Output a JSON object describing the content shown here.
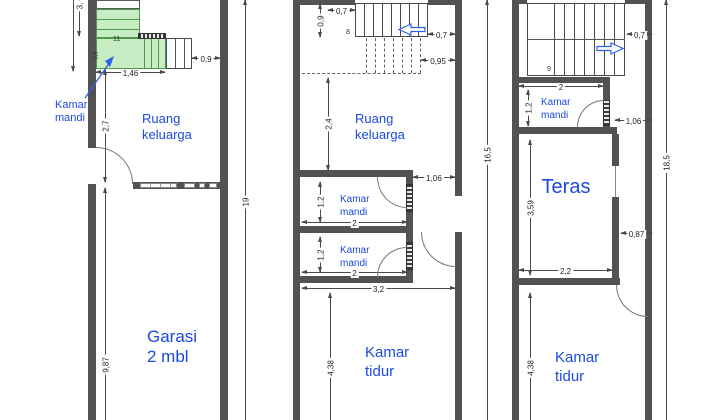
{
  "colors": {
    "wall_gray": "#525252",
    "stair_green_fill": "#c8edc4",
    "stair_green_line": "#4d9a4d",
    "room_label_blue": "#1c49e0",
    "direction_arrow_blue": "#2e62e8"
  },
  "plan_ground": {
    "labels": {
      "kamar_mandi": [
        "Kamar",
        "mandi"
      ],
      "ruang_keluarga": [
        "Ruang",
        "keluarga"
      ],
      "garasi": [
        "Garasi",
        "2 mbl"
      ]
    },
    "dims": {
      "top_cut": "3,",
      "stair_width": "1,46",
      "step_count": "11",
      "stair_inner": "0,9",
      "stair_right": "0,9",
      "hall_height": "2,7",
      "garage_height": "9,87",
      "total_height": "19"
    }
  },
  "plan_middle": {
    "labels": {
      "ruang_keluarga": [
        "Ruang",
        "keluarga"
      ],
      "kamar_mandi_1": [
        "Kamar",
        "mandi"
      ],
      "kamar_mandi_2": [
        "Kamar",
        "mandi"
      ],
      "kamar_tidur": [
        "Kamar",
        "tidur"
      ]
    },
    "dims": {
      "stair_top": "0,7",
      "stair_left": "0,9",
      "step_count": "8",
      "stair_right": "0,7",
      "landing_right": "0,95",
      "living_height": "2,4",
      "door_right": "1,06",
      "bath1_height": "1,2",
      "bath1_width": "2",
      "bath2_height": "1,2",
      "bath2_width": "2",
      "interior_width": "3,2",
      "bedroom_height": "4,38",
      "total_height": "16,5"
    }
  },
  "plan_upper": {
    "labels": {
      "kamar_mandi": [
        "Kamar",
        "mandi"
      ],
      "teras": "Teras",
      "kamar_tidur": [
        "Kamar",
        "tidur"
      ]
    },
    "dims": {
      "stair_right": "0,7",
      "step_count": "9",
      "bath_width": "2",
      "bath_height": "1,2",
      "door_right": "1,06",
      "teras_height": "3,59",
      "teras_right": "0,87",
      "teras_width": "2,2",
      "bedroom_height": "4,38",
      "total_height": "18,5"
    }
  }
}
